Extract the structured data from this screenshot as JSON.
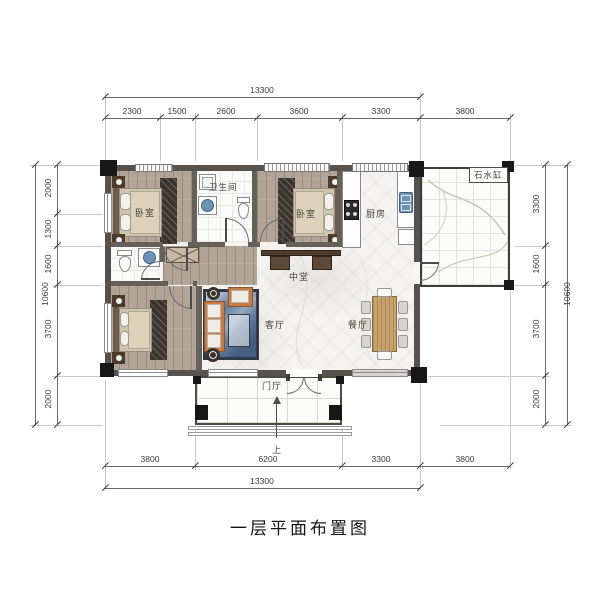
{
  "caption": "一层平面布置图",
  "labels": {
    "bedroom_tl": "卧室",
    "bedroom_tm": "卧室",
    "bedroom_bl": "卧室",
    "bathroom": "卫生间",
    "kitchen": "厨房",
    "central_hall": "中堂",
    "living_room": "客厅",
    "dining_room": "餐厅",
    "foyer": "门厅",
    "stone_water_vat": "石水缸",
    "up": "上"
  },
  "dimensions": {
    "top": {
      "overall": "13300",
      "segments": [
        "2300",
        "1500",
        "2600",
        "3600",
        "3300",
        "3800"
      ]
    },
    "bottom": {
      "overall": "13300",
      "segments": [
        "3800",
        "6200",
        "3300",
        "3800"
      ]
    },
    "left": {
      "overall": "10600",
      "segments": [
        "2000",
        "1300",
        "1600",
        "3700",
        "2000"
      ]
    },
    "right": {
      "overall": "10600",
      "segments": [
        "3300",
        "1600",
        "3700",
        "2000"
      ]
    }
  },
  "colors": {
    "wall": "#57524d",
    "wood_floor": "#b1a496",
    "marble": "#f4f3f0",
    "sofa_accent": "#c87c42",
    "rug_blue": "#5d7da1",
    "fixture_blue": "#6d92b4"
  }
}
